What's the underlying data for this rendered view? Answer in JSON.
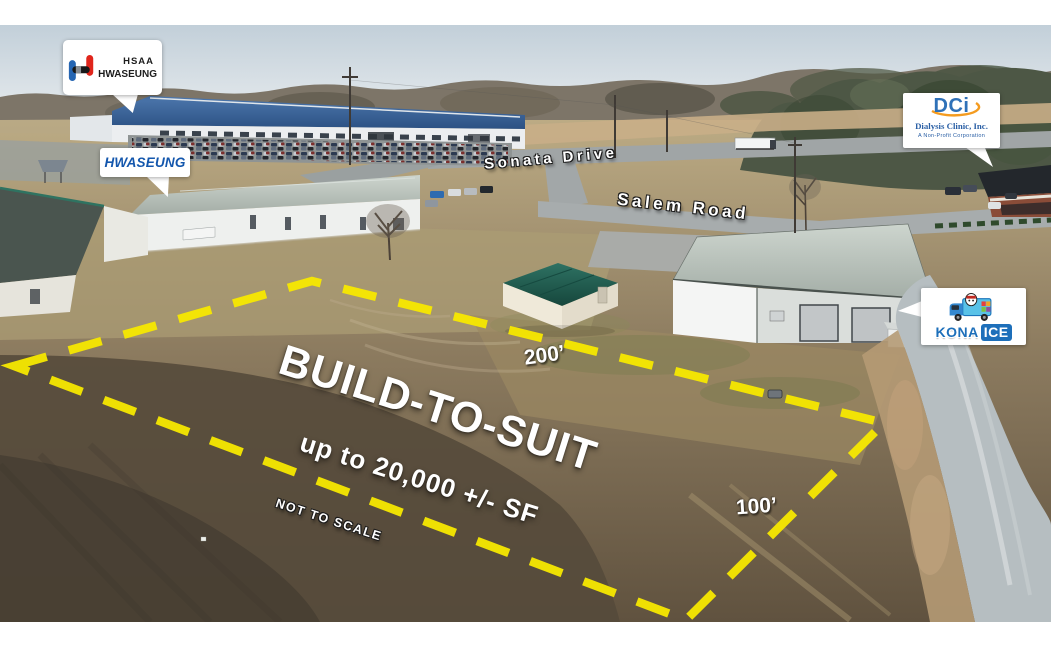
{
  "parcel": {
    "headline": "BUILD-TO-SUIT",
    "subline": "up to 20,000 +/- SF",
    "disclaimer": "NOT TO SCALE",
    "dim_long": "200’",
    "dim_short": "100’"
  },
  "roads": {
    "sonata": "Sonata Drive",
    "salem": "Salem Road"
  },
  "callouts": {
    "hsaa": {
      "line1": "HSAA",
      "line2": "HWASEUNG"
    },
    "hwaseung": {
      "label": "HWASEUNG"
    },
    "dci": {
      "abbr": "DCi",
      "name": "Dialysis Clinic, Inc.",
      "tagline": "A Non-Profit Corporation"
    },
    "kona": {
      "word1": "KONA",
      "word2": "ICE"
    }
  },
  "colors": {
    "boundary": "#f7e800",
    "hwaseung_blue": "#1457ad",
    "dci_blue": "#2f71b8",
    "dci_orange": "#f49b1f",
    "kona_blue": "#1d6fba",
    "factory_roof_blue": "#3b6298",
    "shed_roof_teal": "#1f5c50",
    "sky": "#c2cfd9",
    "field_dirt": "#6f604c"
  }
}
